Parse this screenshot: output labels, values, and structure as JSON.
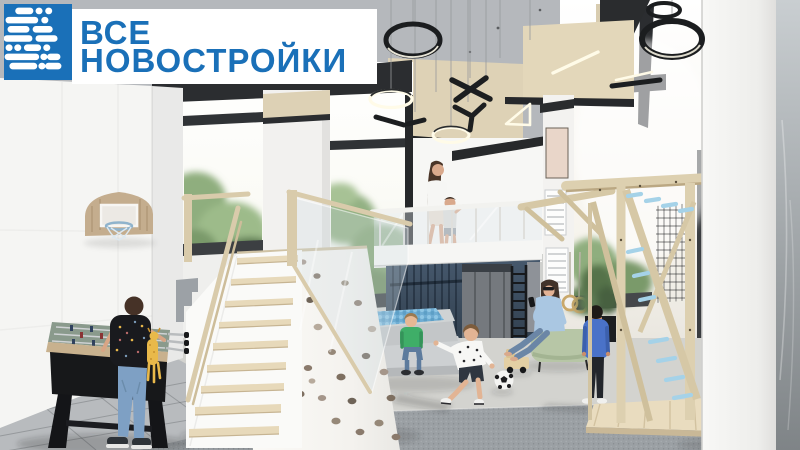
{
  "logo": {
    "line1": "ВСЕ",
    "line2": "НОВОСТРОЙКИ",
    "brand_blue": "#1a70b8",
    "panel_bg": "#ffffff",
    "mark_color": "#ffffff",
    "mark_style": "dotted-dash letter B monogram"
  },
  "scene": {
    "type": "architectural-interior-render",
    "room": "children-playroom-with-mezzanine",
    "palette": {
      "ceiling_concrete": "#b5b8bc",
      "wall_white": "#f4f4f2",
      "soffit_beige": "#ded2b6",
      "trim_black": "#26282b",
      "wood_light": "#ddd0b0",
      "nook_navy": "#3d4f63",
      "ball_pit_blue": "#79b4d6",
      "rung_blue": "#a5d2e8",
      "ottoman_sage": "#b7c6a6",
      "carpet_gray": "#9ba0a4",
      "tile_gray": "#b8bbbe",
      "greenery": "#8fae7e"
    },
    "elements": [
      "ring-pendant-lights",
      "x-shaped-pendant-lights",
      "y-shaped-pendant-light",
      "triangle-pendant-light",
      "panoramic-windows",
      "white-column",
      "basketball-hoop",
      "foosball-table",
      "boy-with-backpack-and-plush",
      "staircase",
      "climbing-slope-with-holds",
      "glass-balustrade",
      "mezzanine",
      "woman-and-child-on-mezzanine",
      "navy-slatted-nook",
      "wall-ladder",
      "ball-pit",
      "boy-sitting-on-step",
      "boy-running-to-ball",
      "soccer-ball",
      "wooden-toy-truck",
      "gymnastic-rings",
      "woman-on-ottoman",
      "potted-plant",
      "framed-wall-posters",
      "standing-boy",
      "wooden-climbing-frame-with-blue-rungs",
      "cargo-net",
      "wooden-deck",
      "gray-carpet",
      "tiled-floor"
    ]
  }
}
